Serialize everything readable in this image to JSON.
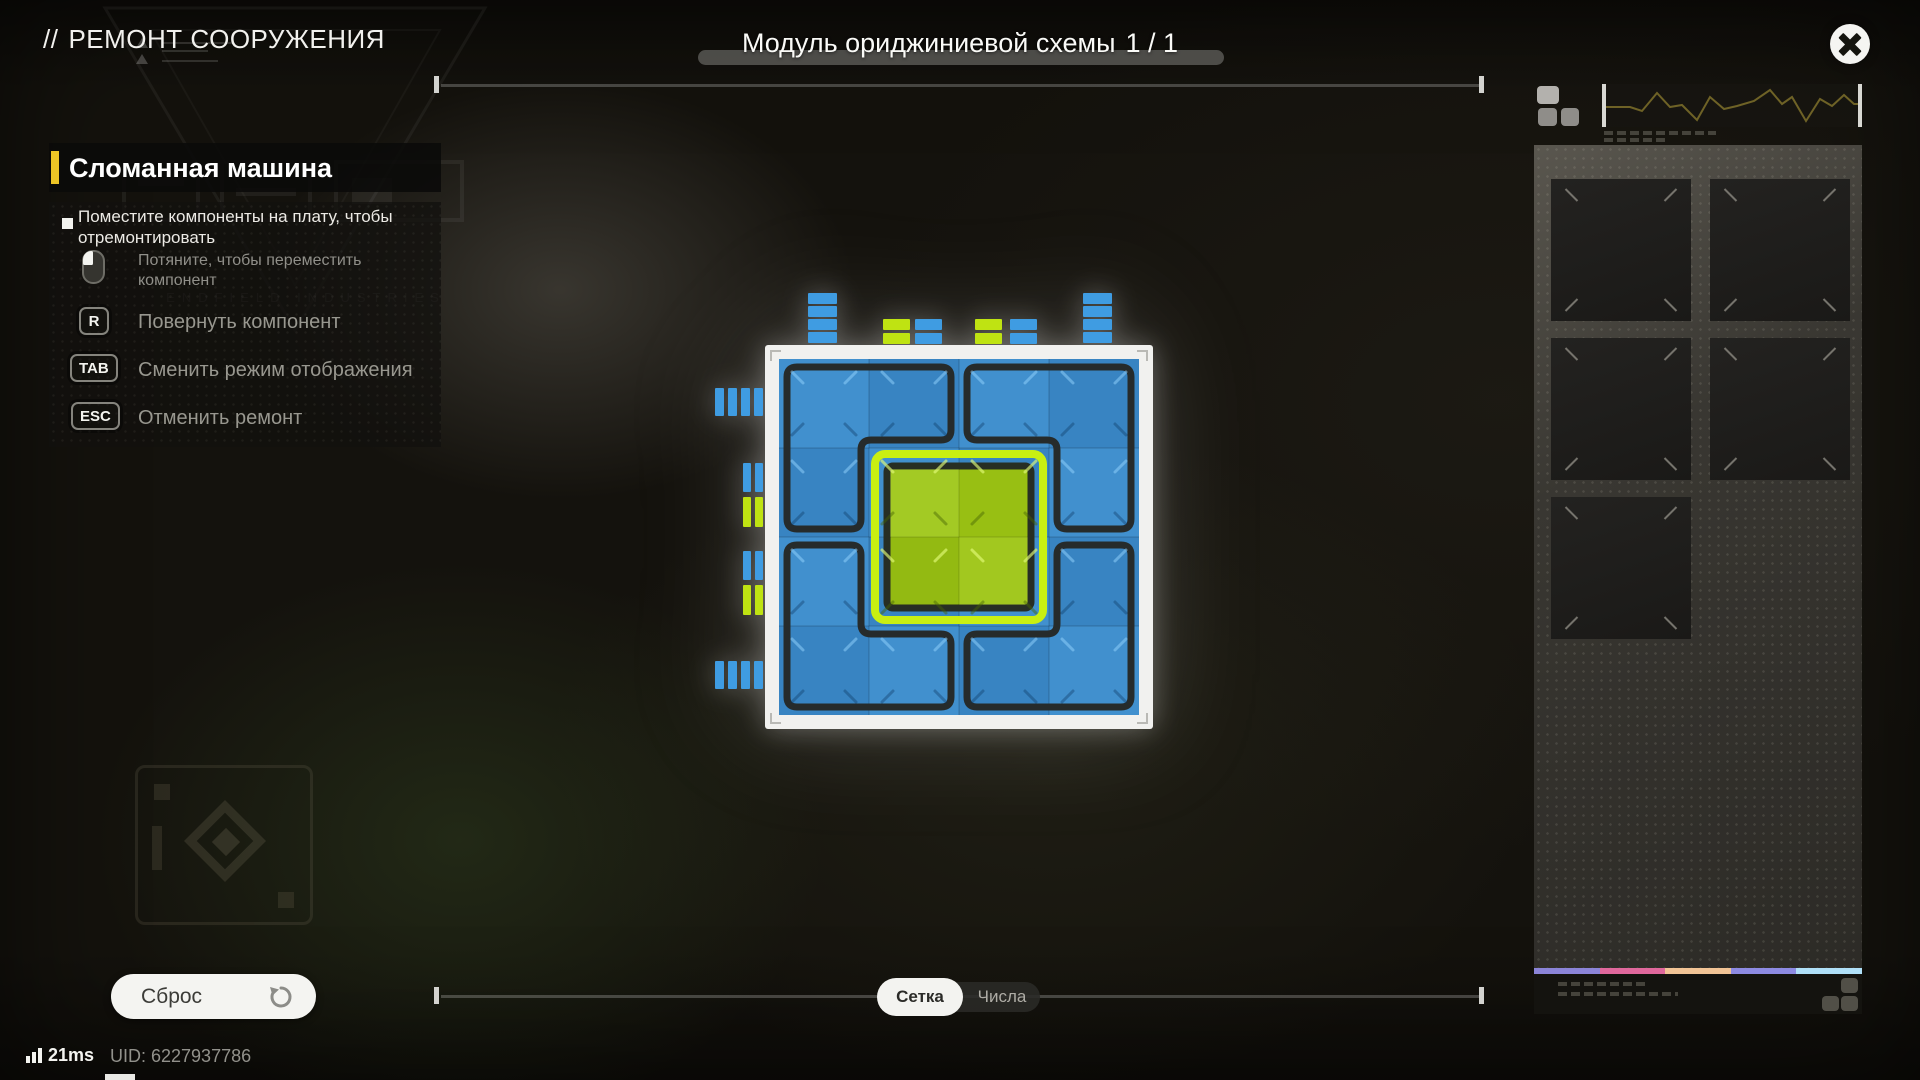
{
  "header": {
    "breadcrumb_prefix": "//",
    "title": "РЕМОНТ СООРУЖЕНИЯ",
    "watermark_line": "ENDFIELD INDUSTRIES"
  },
  "module": {
    "label": "Модуль ориджиниевой схемы",
    "count": "1 / 1"
  },
  "instructions": {
    "panel_title": "Сломанная машина",
    "objective": "Поместите компоненты на плату, чтобы отремонтировать",
    "hints": [
      {
        "key": "LMB",
        "icon": "mouse-left-icon",
        "label": "Потяните, чтобы переместить компонент"
      },
      {
        "key": "R",
        "label": "Повернуть компонент"
      },
      {
        "key": "TAB",
        "label": "Сменить режим отображения"
      },
      {
        "key": "ESC",
        "label": "Отменить ремонт"
      }
    ]
  },
  "board": {
    "grid": 4,
    "colors": {
      "frame": "#f1f1ef",
      "blue": "#3b8ccd",
      "outline": "#262b2b",
      "green": "#9dc614",
      "green_edge": "#c9ef12",
      "green_outline": "#272e24",
      "pin_blue": "#3f9ce2",
      "pin_green": "#bfe312"
    },
    "frame": [
      65,
      60,
      388,
      384
    ],
    "interior": [
      79,
      74,
      360,
      356
    ],
    "cell": [
      90,
      89
    ],
    "pieces": [
      {
        "name": "corner-tl",
        "path": "M 97 82 H 241 Q 251 82 251 92 V 145 Q 251 155 241 155 H 171 Q 161 155 161 165 V 234 Q 161 244 151 244 H 97 Q 87 244 87 234 V 92 Q 87 82 97 82 Z"
      },
      {
        "name": "corner-tr",
        "path": "M 277 82 H 421 Q 431 82 431 92 V 234 Q 431 244 421 244 H 367 Q 357 244 357 234 V 165 Q 357 155 347 155 H 277 Q 267 155 267 145 V 92 Q 267 82 277 82 Z"
      },
      {
        "name": "corner-bl",
        "path": "M 97 260 H 151 Q 161 260 161 270 V 339 Q 161 349 171 349 H 241 Q 251 349 251 359 V 412 Q 251 422 241 422 H 97 Q 87 422 87 412 V 270 Q 87 260 97 260 Z"
      },
      {
        "name": "corner-br",
        "path": "M 367 260 H 421 Q 431 260 431 270 V 412 Q 431 422 421 422 H 277 Q 267 422 267 412 V 359 Q 267 349 277 349 H 347 Q 357 349 357 339 V 270 Q 357 260 367 260 Z"
      }
    ],
    "green_piece": {
      "outer": [
        175,
        169,
        168,
        166
      ],
      "inner": [
        187,
        181,
        144,
        142
      ]
    },
    "pins": [
      [
        108,
        8,
        29,
        11,
        "b"
      ],
      [
        108,
        21,
        29,
        11,
        "b"
      ],
      [
        108,
        34,
        29,
        11,
        "b"
      ],
      [
        108,
        47,
        29,
        11,
        "b"
      ],
      [
        383,
        8,
        29,
        11,
        "b"
      ],
      [
        383,
        21,
        29,
        11,
        "b"
      ],
      [
        383,
        34,
        29,
        11,
        "b"
      ],
      [
        383,
        47,
        29,
        11,
        "b"
      ],
      [
        183,
        34,
        27,
        11,
        "g"
      ],
      [
        183,
        48,
        27,
        11,
        "g"
      ],
      [
        215,
        34,
        27,
        11,
        "b"
      ],
      [
        215,
        48,
        27,
        11,
        "b"
      ],
      [
        275,
        34,
        27,
        11,
        "g"
      ],
      [
        275,
        48,
        27,
        11,
        "g"
      ],
      [
        310,
        34,
        27,
        11,
        "b"
      ],
      [
        310,
        48,
        27,
        11,
        "b"
      ],
      [
        15,
        103,
        9,
        28,
        "b"
      ],
      [
        28,
        103,
        9,
        28,
        "b"
      ],
      [
        41,
        103,
        9,
        28,
        "b"
      ],
      [
        54,
        103,
        9,
        28,
        "b"
      ],
      [
        43,
        178,
        8,
        29,
        "b"
      ],
      [
        55,
        178,
        8,
        29,
        "b"
      ],
      [
        43,
        212,
        8,
        30,
        "g"
      ],
      [
        55,
        212,
        8,
        30,
        "g"
      ],
      [
        43,
        266,
        8,
        29,
        "b"
      ],
      [
        55,
        266,
        8,
        29,
        "b"
      ],
      [
        43,
        300,
        8,
        30,
        "g"
      ],
      [
        55,
        300,
        8,
        30,
        "g"
      ],
      [
        15,
        376,
        9,
        28,
        "b"
      ],
      [
        28,
        376,
        9,
        28,
        "b"
      ],
      [
        41,
        376,
        9,
        28,
        "b"
      ],
      [
        54,
        376,
        9,
        28,
        "b"
      ]
    ]
  },
  "inventory": {
    "slot_count": 5,
    "columns": 2
  },
  "controls": {
    "reset_label": "Сброс",
    "view_toggle": {
      "options": [
        "Сетка",
        "Числа"
      ],
      "selected": "Сетка"
    }
  },
  "status": {
    "ping": "21ms",
    "uid": "UID: 6227937786"
  },
  "colors": {
    "accent_yellow": "#edc525",
    "strip": [
      "#8b84d8",
      "#e0689c",
      "#f2c496",
      "#8d8ae2",
      "#b0e0f8"
    ]
  }
}
